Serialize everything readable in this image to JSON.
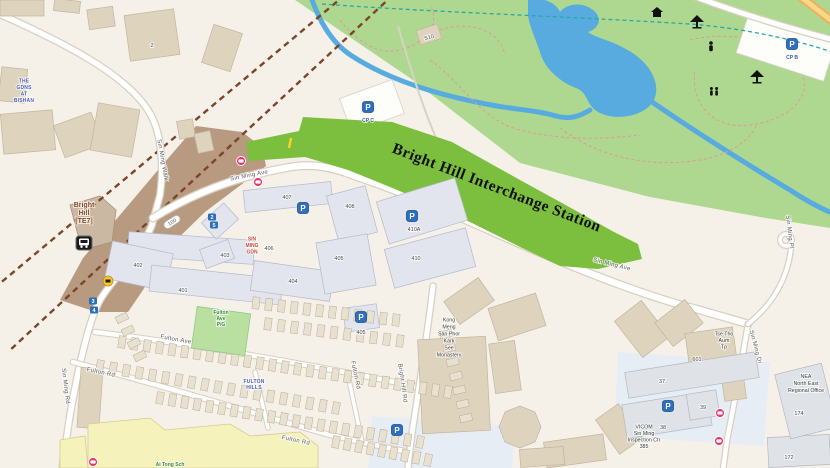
{
  "title": "Street map of Bright Hill Interchange Station and Sin Ming area",
  "overlay": {
    "station_polygon_label": "Bright Hill Interchange Station"
  },
  "colors": {
    "park": "#aed890",
    "station": "#7cbf3f",
    "water": "#58abdf",
    "construction": "#b79a80",
    "rail": "#7b452a",
    "pcn": "#2ba8a0",
    "parking": "#2e6fc0",
    "bus_stop": "#e8326e",
    "mrt": "#1a1a1a",
    "camera": "#f7c52e",
    "exit_pill": "#2a6fb8"
  },
  "labels": [
    {
      "id": "sin-ming-walk",
      "c": "road",
      "x": 163,
      "y": 160,
      "r": 80,
      "lines": [
        "Sin Ming Walk"
      ]
    },
    {
      "id": "sin-ming-ave-1",
      "c": "road",
      "x": 249,
      "y": 175,
      "r": -11,
      "lines": [
        "Sin Ming Ave"
      ]
    },
    {
      "id": "sin-ming-ave-2",
      "c": "road",
      "x": 612,
      "y": 264,
      "r": 14,
      "lines": [
        "Sin Ming Ave"
      ]
    },
    {
      "id": "sin-ming-rd",
      "c": "road",
      "x": 66,
      "y": 386,
      "r": 83,
      "lines": [
        "Sin Ming Rd"
      ]
    },
    {
      "id": "sin-ming-pl",
      "c": "road",
      "x": 790,
      "y": 232,
      "r": 83,
      "lines": [
        "Sin Ming Pl"
      ]
    },
    {
      "id": "sin-ming-dr",
      "c": "road",
      "x": 756,
      "y": 347,
      "r": 75,
      "lines": [
        "Sin Ming Dr"
      ]
    },
    {
      "id": "fulton-ave",
      "c": "road",
      "x": 176,
      "y": 339,
      "r": 10,
      "lines": [
        "Fulton Ave"
      ]
    },
    {
      "id": "fulton-rd-1",
      "c": "road",
      "x": 101,
      "y": 372,
      "r": 12,
      "lines": [
        "Fulton Rd"
      ]
    },
    {
      "id": "fulton-rd-2",
      "c": "road",
      "x": 296,
      "y": 440,
      "r": 12,
      "lines": [
        "Fulton Rd"
      ]
    },
    {
      "id": "fulton-rd-3",
      "c": "road",
      "x": 356,
      "y": 375,
      "r": 78,
      "lines": [
        "Fulton Rd"
      ]
    },
    {
      "id": "bright-hill-rd",
      "c": "road",
      "x": 403,
      "y": 383,
      "r": 82,
      "lines": [
        "Bright Hill Rd"
      ]
    },
    {
      "id": "gdns-at-bishan",
      "c": "place-blue",
      "x": 24,
      "y": 90,
      "lh": 6.5,
      "lines": [
        "THE",
        "GDNS",
        "AT",
        "BISHAN"
      ]
    },
    {
      "id": "sin-ming-gdn",
      "c": "place-red",
      "x": 252,
      "y": 245,
      "lh": 6.5,
      "lines": [
        "SIN",
        "MING",
        "GDN"
      ]
    },
    {
      "id": "fulton-hills",
      "c": "place-blue",
      "x": 254,
      "y": 384,
      "lh": 6,
      "lines": [
        "FULTON",
        "HILLS"
      ]
    },
    {
      "id": "fulton-ave-pg",
      "c": "place-green",
      "x": 221,
      "y": 318,
      "lh": 6,
      "lines": [
        "Fulton",
        "Ave",
        "P/G"
      ]
    },
    {
      "id": "ai-tong-sch",
      "c": "place-green",
      "x": 170,
      "y": 464,
      "lines": [
        "Ai Tong Sch"
      ]
    },
    {
      "id": "monastery",
      "c": "place-dark",
      "x": 449,
      "y": 337,
      "lh": 7,
      "lines": [
        "Kong",
        "Meng",
        "San Phor",
        "Kark",
        "See",
        "Monastery"
      ]
    },
    {
      "id": "tse-tho-aum-tp",
      "c": "place-dark",
      "x": 724,
      "y": 340,
      "lh": 6.5,
      "lines": [
        "Tse Tho",
        "Aum",
        "Tp"
      ]
    },
    {
      "id": "nea-office",
      "c": "place-dark",
      "x": 806,
      "y": 383,
      "lh": 7,
      "lines": [
        "NEA",
        "North East",
        "Regional Office"
      ]
    },
    {
      "id": "vicom",
      "c": "place-dark",
      "x": 644,
      "y": 436,
      "lh": 6.5,
      "lines": [
        "VICOM",
        "Sin Ming",
        "Inspection Ctr",
        "385"
      ]
    },
    {
      "id": "bright-hill-mrt-name",
      "c": "station",
      "x": 84,
      "y": 213,
      "lh": 8,
      "lines": [
        "Bright",
        "Hill",
        "[TE7]"
      ]
    },
    {
      "id": "cp-c",
      "c": "cp",
      "x": 368,
      "y": 120,
      "lines": [
        "CP C"
      ]
    },
    {
      "id": "cp-b",
      "c": "cp",
      "x": 792,
      "y": 57,
      "lines": [
        "CP B"
      ]
    },
    {
      "id": "blk-407",
      "c": "bnum",
      "x": 287,
      "y": 197,
      "lines": [
        "407"
      ]
    },
    {
      "id": "blk-408",
      "c": "bnum",
      "x": 350,
      "y": 206,
      "lines": [
        "408"
      ]
    },
    {
      "id": "blk-406",
      "c": "bnum",
      "x": 269,
      "y": 248,
      "lines": [
        "406"
      ]
    },
    {
      "id": "blk-403",
      "c": "bnum",
      "x": 225,
      "y": 255,
      "lines": [
        "403"
      ]
    },
    {
      "id": "blk-402",
      "c": "bnum",
      "x": 138,
      "y": 265,
      "lines": [
        "402"
      ]
    },
    {
      "id": "blk-401",
      "c": "bnum",
      "x": 183,
      "y": 290,
      "lines": [
        "401"
      ]
    },
    {
      "id": "blk-404",
      "c": "bnum",
      "x": 293,
      "y": 281,
      "lines": [
        "404"
      ]
    },
    {
      "id": "blk-405",
      "c": "bnum",
      "x": 339,
      "y": 258,
      "lines": [
        "405"
      ]
    },
    {
      "id": "cp-405",
      "c": "bnum",
      "x": 361,
      "y": 332,
      "lines": [
        "405"
      ]
    },
    {
      "id": "blk-410a",
      "c": "bnum",
      "x": 414,
      "y": 229,
      "lines": [
        "410A"
      ]
    },
    {
      "id": "blk-410",
      "c": "bnum",
      "x": 416,
      "y": 258,
      "lines": [
        "410"
      ]
    },
    {
      "id": "blk-2",
      "c": "bnum",
      "x": 152,
      "y": 45,
      "lines": [
        "2"
      ]
    },
    {
      "id": "blk-s10",
      "c": "bnum",
      "x": 429,
      "y": 37,
      "r": -15,
      "lines": [
        "S10"
      ]
    },
    {
      "id": "blk-601",
      "c": "bnum",
      "x": 697,
      "y": 359,
      "lines": [
        "601"
      ]
    },
    {
      "id": "blk-37",
      "c": "bnum",
      "x": 662,
      "y": 381,
      "lines": [
        "37"
      ]
    },
    {
      "id": "blk-38",
      "c": "bnum",
      "x": 663,
      "y": 427,
      "lines": [
        "38"
      ]
    },
    {
      "id": "blk-39",
      "c": "bnum",
      "x": 703,
      "y": 407,
      "lines": [
        "39"
      ]
    },
    {
      "id": "blk-172",
      "c": "bnum",
      "x": 789,
      "y": 457,
      "lines": [
        "172"
      ]
    },
    {
      "id": "blk-174",
      "c": "bnum",
      "x": 799,
      "y": 413,
      "lines": [
        "174"
      ]
    }
  ],
  "icons": [
    {
      "type": "parking",
      "x": 368,
      "y": 107
    },
    {
      "type": "parking",
      "x": 792,
      "y": 44
    },
    {
      "type": "parking",
      "x": 303,
      "y": 208
    },
    {
      "type": "parking",
      "x": 412,
      "y": 216
    },
    {
      "type": "parking",
      "x": 361,
      "y": 317
    },
    {
      "type": "parking",
      "x": 668,
      "y": 406
    },
    {
      "type": "parking",
      "x": 397,
      "y": 430
    },
    {
      "type": "bus-stop",
      "x": 241,
      "y": 161
    },
    {
      "type": "bus-stop",
      "x": 258,
      "y": 182
    },
    {
      "type": "bus-stop",
      "x": 720,
      "y": 413
    },
    {
      "type": "bus-stop",
      "x": 719,
      "y": 441
    },
    {
      "type": "bus-stop",
      "x": 93,
      "y": 462
    },
    {
      "type": "mrt-station",
      "x": 84,
      "y": 243
    },
    {
      "type": "camera",
      "x": 108,
      "y": 281
    },
    {
      "type": "exit",
      "x": 93,
      "y": 301,
      "label": "3"
    },
    {
      "type": "exit",
      "x": 94,
      "y": 310,
      "label": "4"
    },
    {
      "type": "exit",
      "x": 212,
      "y": 217,
      "label": "2"
    },
    {
      "type": "exit",
      "x": 214,
      "y": 225,
      "label": "5"
    },
    {
      "type": "road-number",
      "x": 172,
      "y": 222,
      "r": -33,
      "label": "100"
    },
    {
      "type": "shelter",
      "x": 697,
      "y": 22
    },
    {
      "type": "shelter",
      "x": 757,
      "y": 77
    },
    {
      "type": "person",
      "x": 711,
      "y": 47
    },
    {
      "type": "people",
      "x": 714,
      "y": 92
    },
    {
      "type": "hut",
      "x": 657,
      "y": 13
    },
    {
      "type": "entrance-mark",
      "x": 290,
      "y": 143
    }
  ]
}
